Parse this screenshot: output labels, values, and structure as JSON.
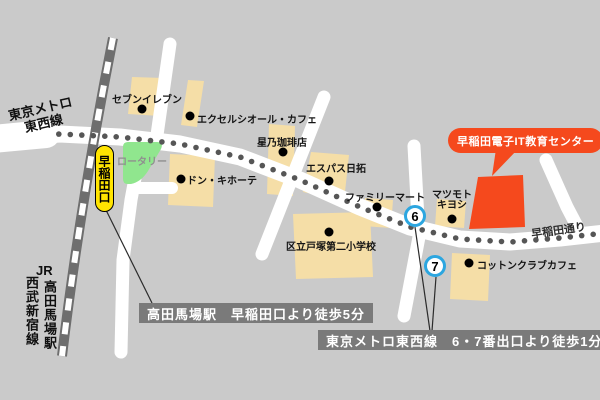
{
  "map": {
    "destination_bubble": "早稲田電子IT教育センター",
    "road_name": "早稲田通り",
    "rotary_label": "ロータリー",
    "station_exit_label": "早稲田口",
    "metro_line": {
      "line1": "東京メトロ",
      "line2": "東西線"
    },
    "left_railway": {
      "jr": "JR",
      "station": "高田馬場駅",
      "seibu_line": "西武新宿線"
    },
    "pois": [
      {
        "id": "seven-eleven",
        "name": "セブンイレブン"
      },
      {
        "id": "excelsior-cafe",
        "name": "エクセルシオール・カフェ"
      },
      {
        "id": "hoshino-coffee",
        "name": "星乃珈琲店"
      },
      {
        "id": "don-quijote",
        "name": "ドン・キホーテ"
      },
      {
        "id": "espace-nittaku",
        "name": "エスパス日拓"
      },
      {
        "id": "family-mart",
        "name": "ファミリーマート"
      },
      {
        "id": "matsumoto-kiyoshi",
        "name": "マツモトキヨシ",
        "lines": [
          "マツモト",
          "キヨシ"
        ]
      },
      {
        "id": "totsuka-dai2-elementary",
        "name": "区立戸塚第二小学校"
      },
      {
        "id": "cotton-club-cafe",
        "name": "コットンクラブカフェ"
      }
    ],
    "exit_numbers": [
      "6",
      "7"
    ],
    "notes": [
      "高田馬場駅　早稲田口より徒歩5分",
      "東京メトロ東西線　6・7番出口より徒歩1分"
    ],
    "colors": {
      "background": "#CACACA",
      "road": "#FFFFFF",
      "building": "#F5DEA7",
      "destination_red": "#F5491D",
      "rotary_green": "#90E68E",
      "highlight_yellow": "#FFE400",
      "exit_circle_blue": "#2CA6E0",
      "note_background": "#7A7A7A",
      "railway_gray": "#6E6E6E",
      "metro_dot_gray": "#565656"
    }
  }
}
